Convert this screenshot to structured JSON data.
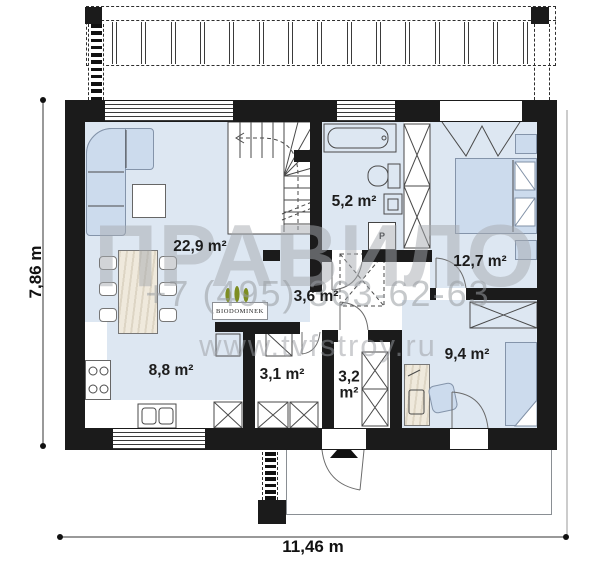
{
  "watermark": {
    "brand": "ПРАВИЛО",
    "phone": "+7 (495) 363-62-63",
    "website": "www.tvfstroy.ru",
    "logo": "BIODOMINEK"
  },
  "dimensions": {
    "width_label": "11,46 m",
    "height_label": "7,86 m"
  },
  "rooms": [
    {
      "id": "living-room",
      "area_label": "22,9 m²"
    },
    {
      "id": "bathroom",
      "area_label": "5,2 m²"
    },
    {
      "id": "bedroom-main",
      "area_label": "12,7 m²"
    },
    {
      "id": "hall",
      "area_label": "3,6 m²"
    },
    {
      "id": "kitchen",
      "area_label": "8,8 m²"
    },
    {
      "id": "pantry",
      "area_label": "3,1 m²"
    },
    {
      "id": "entrance",
      "area_label": "3,2 m²"
    },
    {
      "id": "bedroom-second",
      "area_label": "9,4 m²"
    }
  ],
  "appliances": {
    "washer_label": "P"
  },
  "colors": {
    "wall": "#1b1b1b",
    "floor_blue": "#dde7f2",
    "furniture_blue": "#ccdbed",
    "watermark_gray": "#9a9da2",
    "tree_green": "#7d8d21"
  }
}
